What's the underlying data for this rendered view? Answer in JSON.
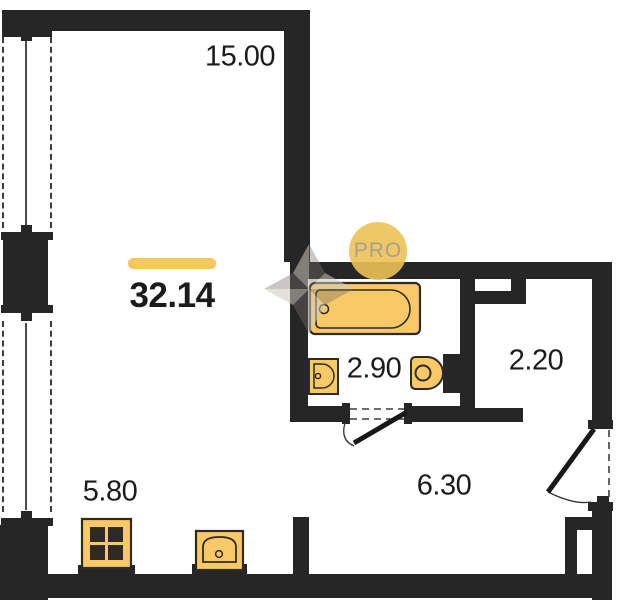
{
  "floorplan": {
    "total_area": {
      "value": "32.14"
    },
    "rooms": [
      {
        "name": "living-room",
        "area": "15.00"
      },
      {
        "name": "bathroom",
        "area": "2.90"
      },
      {
        "name": "hall",
        "area": "2.20"
      },
      {
        "name": "kitchen-zone",
        "area": "5.80"
      },
      {
        "name": "corridor",
        "area": "6.30"
      }
    ],
    "watermark": {
      "badge": "PRO",
      "logo": "pinwheel-icon"
    },
    "fixtures": [
      {
        "name": "bathtub"
      },
      {
        "name": "washbasin"
      },
      {
        "name": "toilet"
      },
      {
        "name": "stove"
      },
      {
        "name": "kitchen-sink"
      }
    ],
    "colors": {
      "wall": "#262626",
      "fixture_fill": "#f8c966",
      "fixture_stroke": "#2e2a24",
      "accent_bar": "#f5c85f",
      "label_text": "#1b1b1b",
      "badge_fill": "#ecc155",
      "badge_text": "#a7a093"
    }
  }
}
